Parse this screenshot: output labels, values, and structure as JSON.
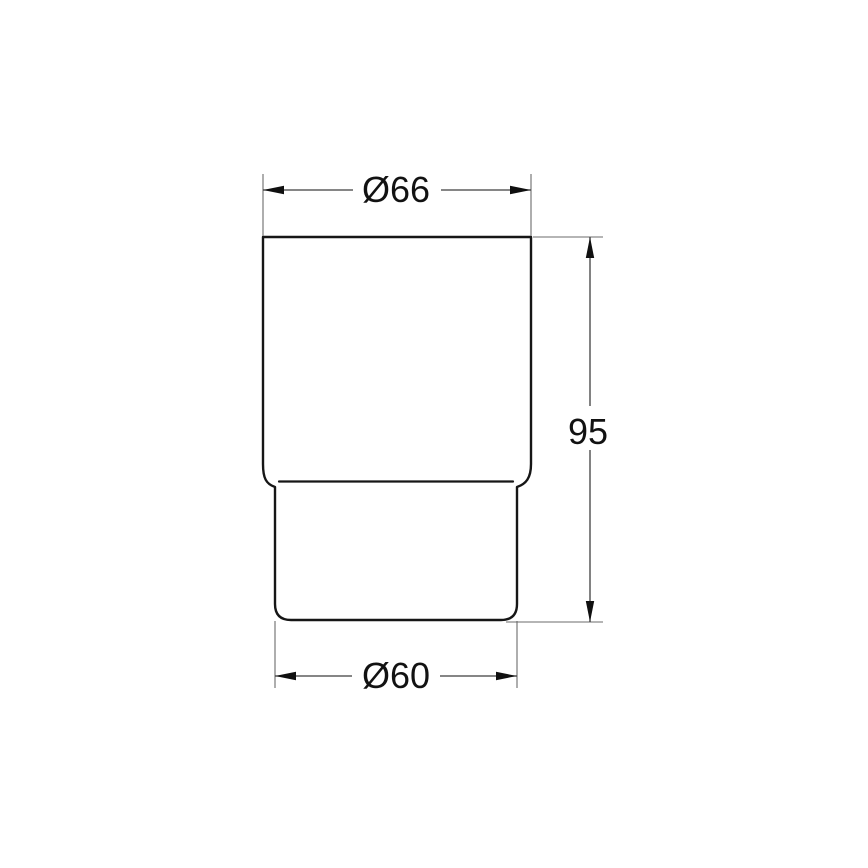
{
  "canvas": {
    "background": "#ffffff"
  },
  "colors": {
    "outline": "#161616",
    "dimension_line": "#3f3f3f",
    "extension_line": "#6b6b6b",
    "arrow": "#101010",
    "label": "#121212"
  },
  "drawing": {
    "kind": "technical-dimension-drawing",
    "dimensions": [
      {
        "id": "top-diameter",
        "label": "Ø66"
      },
      {
        "id": "height",
        "label": "95"
      },
      {
        "id": "bottom-diameter",
        "label": "Ø60"
      }
    ]
  }
}
